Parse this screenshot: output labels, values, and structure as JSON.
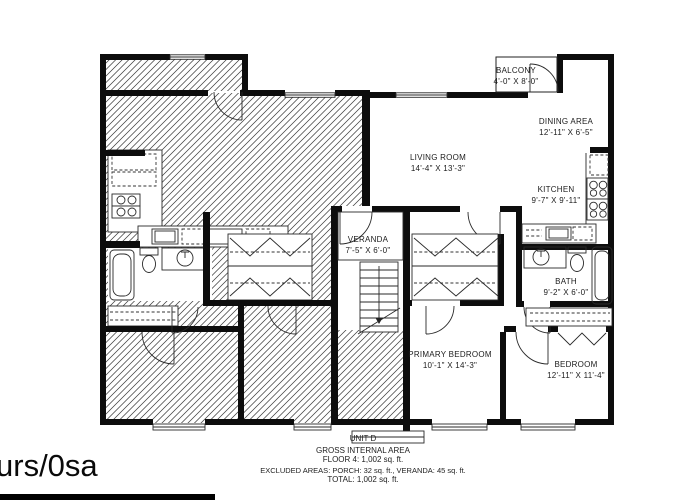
{
  "watermark": "urs/0sa",
  "footer": {
    "unit_label": "UNIT D",
    "line1": "GROSS INTERNAL AREA",
    "line2": "FLOOR 4: 1,002 sq. ft.",
    "line3": "EXCLUDED AREAS: PORCH: 32 sq. ft., VERANDA: 45 sq. ft.",
    "line4": "TOTAL: 1,002 sq. ft."
  },
  "rooms": {
    "balcony": {
      "name": "BALCONY",
      "dims": "4'-0\" X 8'-0\""
    },
    "dining": {
      "name": "DINING AREA",
      "dims": "12'-11\" X 6'-5\""
    },
    "living": {
      "name": "LIVING ROOM",
      "dims": "14'-4\" X 13'-3\""
    },
    "kitchen": {
      "name": "KITCHEN",
      "dims": "9'-7\" X 9'-11\""
    },
    "veranda": {
      "name": "VERANDA",
      "dims": "7'-5\" X 6'-0\""
    },
    "bath": {
      "name": "BATH",
      "dims": "9'-2\" X 6'-0\""
    },
    "primary_bedroom": {
      "name": "PRIMARY BEDROOM",
      "dims": "10'-1\" X 14'-3\""
    },
    "bedroom": {
      "name": "BEDROOM",
      "dims": "12'-11\" X 11'-4\""
    }
  },
  "colors": {
    "background": "#ffffff",
    "wall": "#0d0d0d",
    "hatch": "#3a3a3a",
    "text": "#1c1c1c"
  }
}
